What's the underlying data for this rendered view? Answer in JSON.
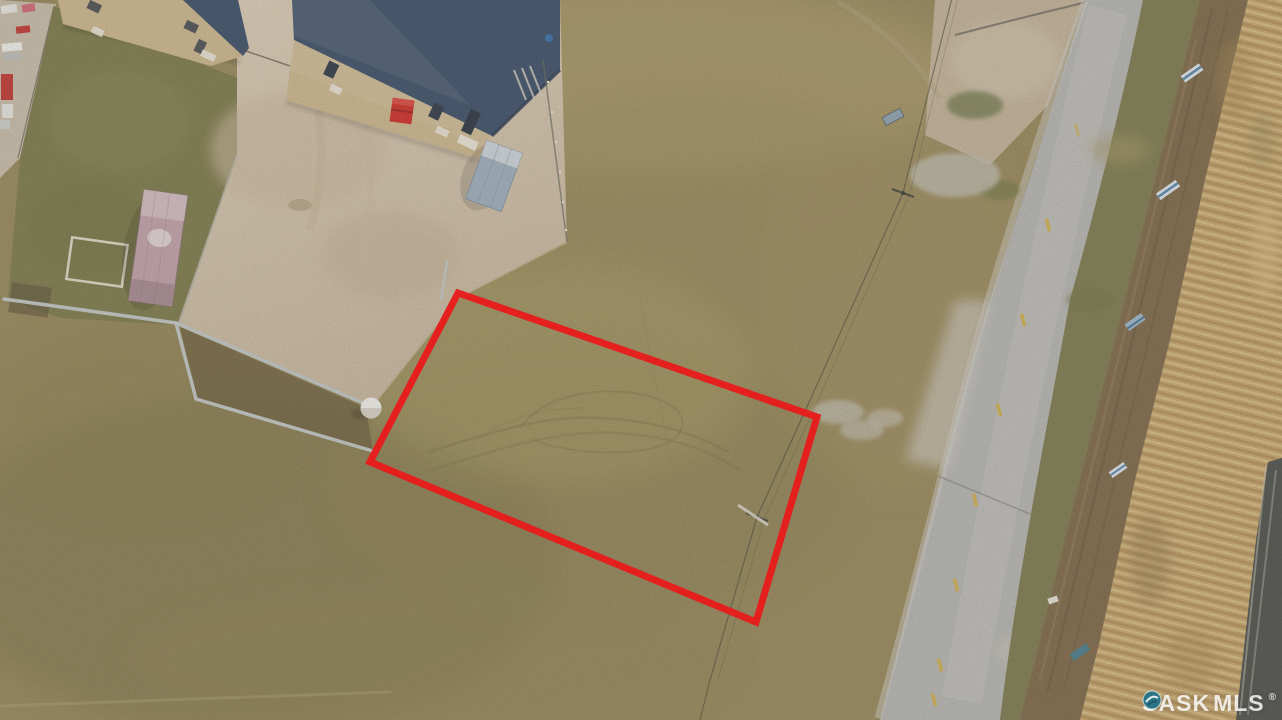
{
  "image": {
    "kind": "aerial-drone-real-estate-photo",
    "subject": "vacant grass parcel outlined in red, beside warehouses and a rural paved road",
    "width_px": 1282,
    "height_px": 720
  },
  "watermark": {
    "left_text": "SASK",
    "right_text": "MLS",
    "registered_symbol": "®",
    "logo": "teal-gem-circle-icon",
    "text_color": "#FFFFFF",
    "logo_color": "#2A7487"
  },
  "boundary_annotation": {
    "type": "property-outline",
    "shape": "quadrilateral",
    "stroke_color": "#E81C1C",
    "stroke_width": 7,
    "points_str": "458,293 817,417 756,622 370,462"
  },
  "scene": {
    "colors": {
      "field_base": "#98885A",
      "left_grass": "#7E7B4B",
      "dirt_yard": "#D3C4AC",
      "building_wall_tan": "#CDB78D",
      "building_roof_navy": "#3E5068",
      "shed_gray_blue": "#9FAFBC",
      "container_pink": "#C2A2A9",
      "dumpster_red": "#CF2F28",
      "barrier_concrete": "#C2C6C2",
      "road_asphalt": "#B6B5B0",
      "road_centerline_yellow": "#D2AE44",
      "verge_green": "#7E7B4F",
      "dirt_trail_brown": "#7F6949",
      "ditch_grass_gold": "#C7A76D",
      "rail_corridor_dark": "#57544C"
    },
    "objects": [
      {
        "name": "industrial-building-west",
        "desc": "tan warehouse with navy roof, top left"
      },
      {
        "name": "industrial-building-east",
        "desc": "tan warehouse with navy roof, loading door and red dumpster"
      },
      {
        "name": "storage-shed",
        "desc": "small gray-blue shed south of east warehouse"
      },
      {
        "name": "pink-shipping-container",
        "desc": "pink container on grass strip"
      },
      {
        "name": "concrete-barriers",
        "desc": "light gray lock-block walls edging the gravel pad"
      },
      {
        "name": "white-dome-tank",
        "desc": "small white dome at barrier corner"
      },
      {
        "name": "vehicles-equipment",
        "desc": "parked trucks and red trailers, top-left corner"
      },
      {
        "name": "power-line",
        "desc": "pole line crossing the field parallel to the road"
      },
      {
        "name": "rural-road",
        "desc": "paved road with yellow dashed centerline, curving at top"
      },
      {
        "name": "roadside-signs",
        "desc": "small metal signs along the east ditch"
      },
      {
        "name": "ditch-and-rail-corridor",
        "desc": "golden grass ditch and dark corridor at far right"
      },
      {
        "name": "outlined-vacant-lot",
        "desc": "grassy parcel outlined in red"
      }
    ]
  }
}
